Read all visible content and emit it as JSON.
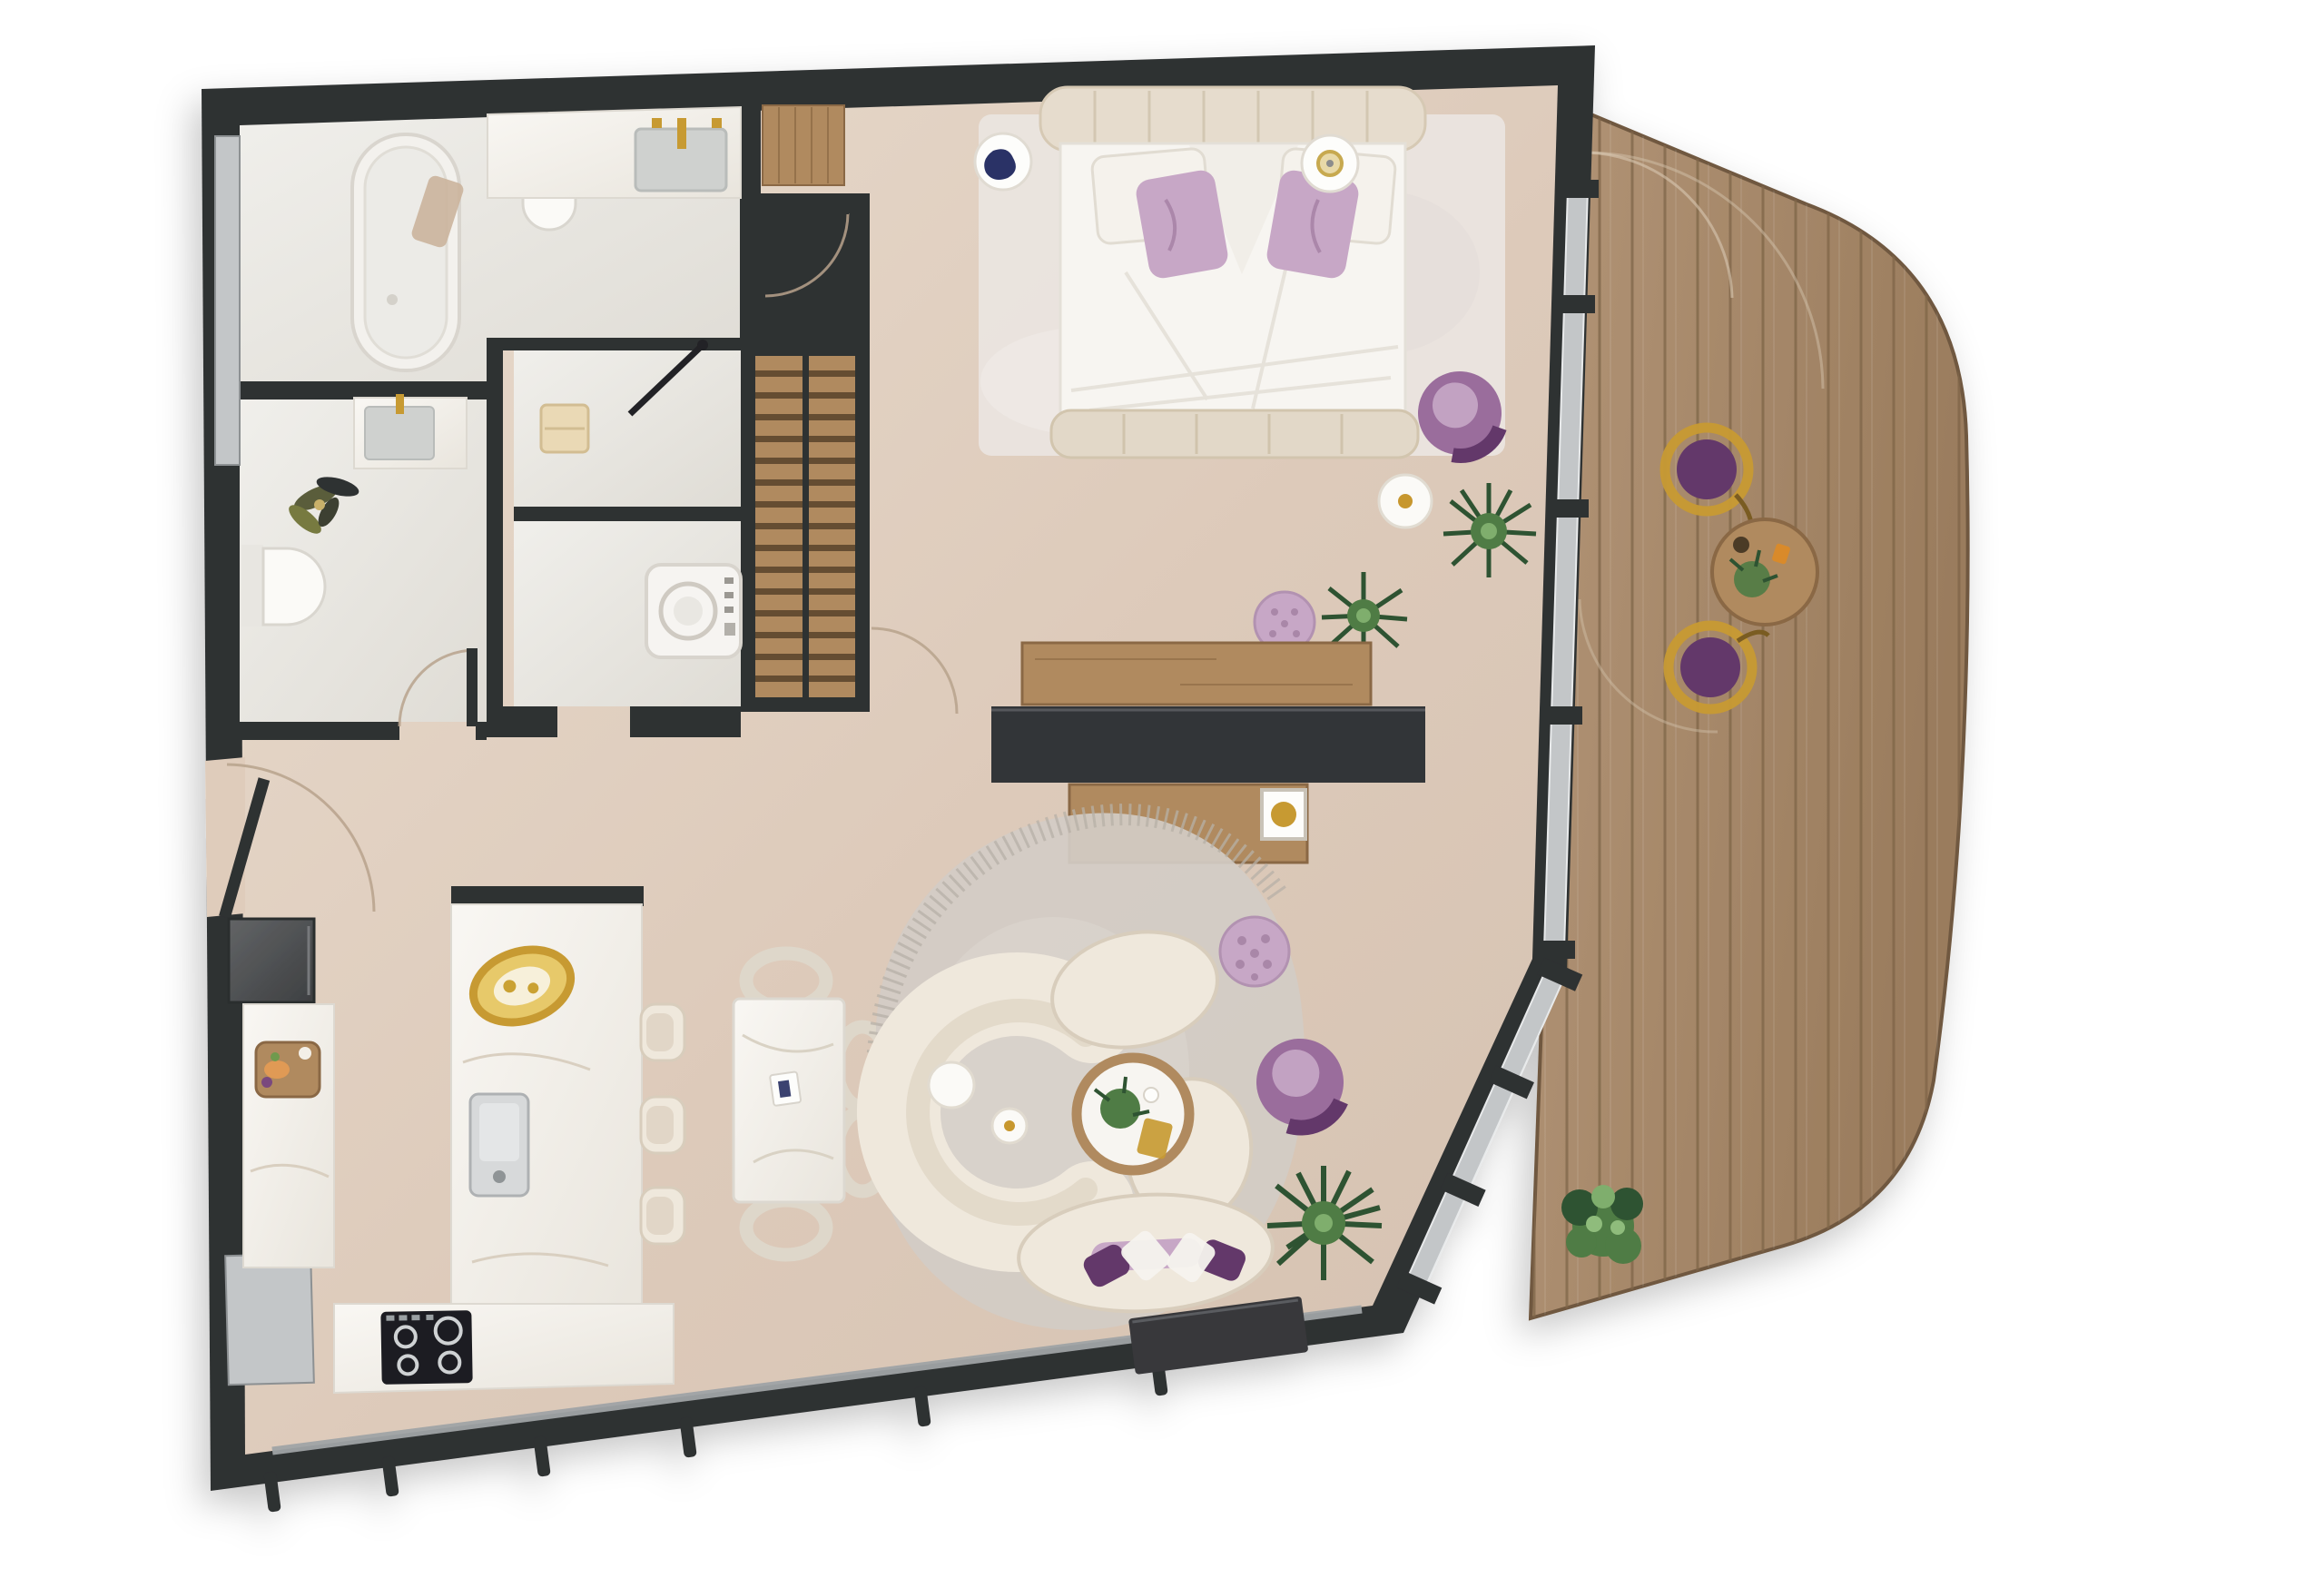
{
  "title": "apartment-floor-plan-top-view",
  "palette": {
    "wall": "#2f3032",
    "wallSoft": "#54575a",
    "glass": "#c3c6c8",
    "glassDim": "#9fa3a5",
    "floorLight": "#e8dbcd",
    "floorDark": "#d5c2b1",
    "wetLight": "#efeeea",
    "wetDark": "#dfdcd5",
    "counterLight": "#f8f6f2",
    "counterDark": "#eae6de",
    "deckLight": "#b29476",
    "deckDark": "#9a7c5d",
    "deckLine": "#7e6548",
    "cream": "#efe8dc",
    "creamShade": "#d8cdbc",
    "purple": "#9a6d9c",
    "purpleDeep": "#63386b",
    "lilac": "#c7a7c6",
    "green": "#4f7b44",
    "greenDeep": "#2f5230",
    "gold": "#c79a33",
    "wood": "#b08a5e",
    "woodDeep": "#8a6844",
    "rug": "#d2ccc5",
    "rugEdge": "#b7b0a7",
    "white": "#fbfaf8",
    "appliance": "#1d1e20",
    "arc": "#b7a28c"
  },
  "rooms": [
    {
      "name": "bathroom",
      "furniture": [
        "freestanding-bathtub",
        "wall-hung-toilet",
        "vanity-sink",
        "gold-faucet",
        "frosted-window"
      ]
    },
    {
      "name": "powder-room",
      "furniture": [
        "wall-hung-toilet",
        "small-vanity",
        "plant"
      ]
    },
    {
      "name": "shower-room",
      "furniture": [
        "bench",
        "glass-pivot-door"
      ]
    },
    {
      "name": "utility-room",
      "furniture": [
        "washing-machine"
      ]
    },
    {
      "name": "wardrobe",
      "furniture": [
        "slatted-shelving",
        "center-divider"
      ]
    },
    {
      "name": "entry-hall",
      "furniture": [
        "wood-doormat",
        "entry-door-swing"
      ]
    },
    {
      "name": "bedroom",
      "furniture": [
        "double-bed",
        "tufted-headboard",
        "purple-pillows",
        "nightstand-plate-left",
        "nightstand-plate-right",
        "area-rug",
        "purple-armchair",
        "round-side-table",
        "palm-plant",
        "tufted-pouf",
        "wood-console",
        "media-partition",
        "desk",
        "desk-chair",
        "gold-art-frame"
      ]
    },
    {
      "name": "kitchen",
      "furniture": [
        "fridge",
        "left-counter",
        "cutting-board",
        "island-peninsula",
        "gold-bowl",
        "sink",
        "cooktop",
        "bar-stools"
      ]
    },
    {
      "name": "dining-area",
      "furniture": [
        "marble-dining-table",
        "ring-chairs",
        "book-decor"
      ]
    },
    {
      "name": "living-room",
      "furniture": [
        "curved-sectional-sofa",
        "round-coffee-table",
        "nesting-side-tables",
        "purple-armchair",
        "tufted-pouf",
        "palm-plant",
        "tv-console",
        "organic-rug",
        "purple-cushions"
      ]
    },
    {
      "name": "terrace",
      "furniture": [
        "wood-decking",
        "bistro-table",
        "bistro-chairs",
        "shrub",
        "door-swing-arcs"
      ]
    }
  ]
}
